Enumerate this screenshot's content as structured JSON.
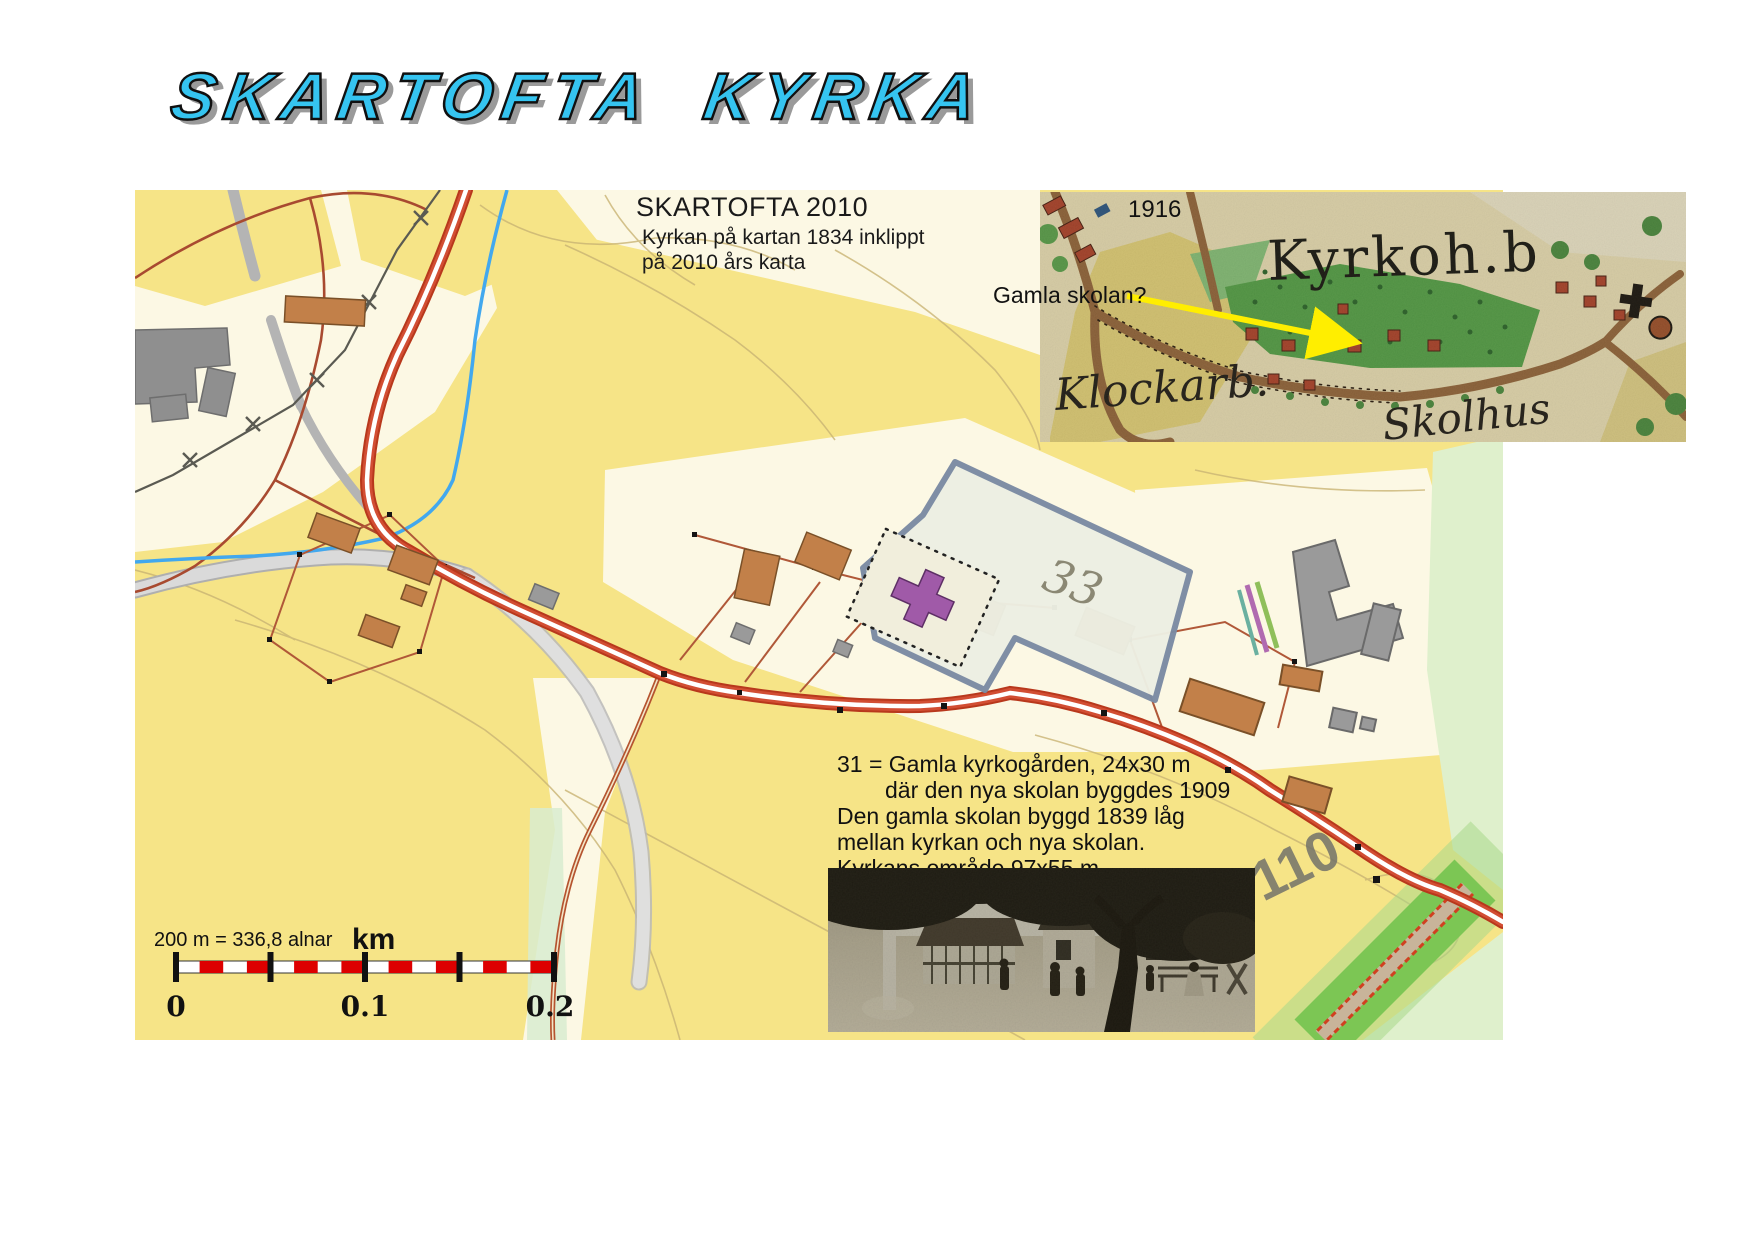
{
  "title": "SKARTOFTA  KYRKA",
  "map2010": {
    "heading": "SKARTOFTA 2010",
    "caption_line1": "Kyrkan på kartan 1834 inklippt",
    "caption_line2": "på 2010 års karta",
    "label_33": "33",
    "label_110": "110",
    "note_line1": "31 = Gamla kyrkogården, 24x30 m",
    "note_line2": "där den nya skolan byggdes 1909",
    "note_line3": "Den gamla skolan byggd 1839 låg",
    "note_line4": "mellan kyrkan och nya skolan.",
    "note_line5": "Kyrkans område 97x55 m"
  },
  "inset1916": {
    "year_label": "1916",
    "annotation": "Gamla skolan?",
    "label_kyrkohb": "Kyrkoh.b",
    "label_klockarb": "Klockarb.",
    "label_skolhus": "Skolhus"
  },
  "scalebar": {
    "equivalence": "200 m = 336,8 alnar",
    "unit": "km",
    "tick_0": "0",
    "tick_01": "0.1",
    "tick_02": "0.2"
  },
  "colors": {
    "title_cyan": "#35c4f0",
    "map_yellow": "#f8e992",
    "map_cream": "#fcf8e4",
    "road_red": "#c23b1f",
    "stream_blue": "#42a8ee",
    "green_road": "#7cc654",
    "arrow_yellow": "#ffee00"
  }
}
